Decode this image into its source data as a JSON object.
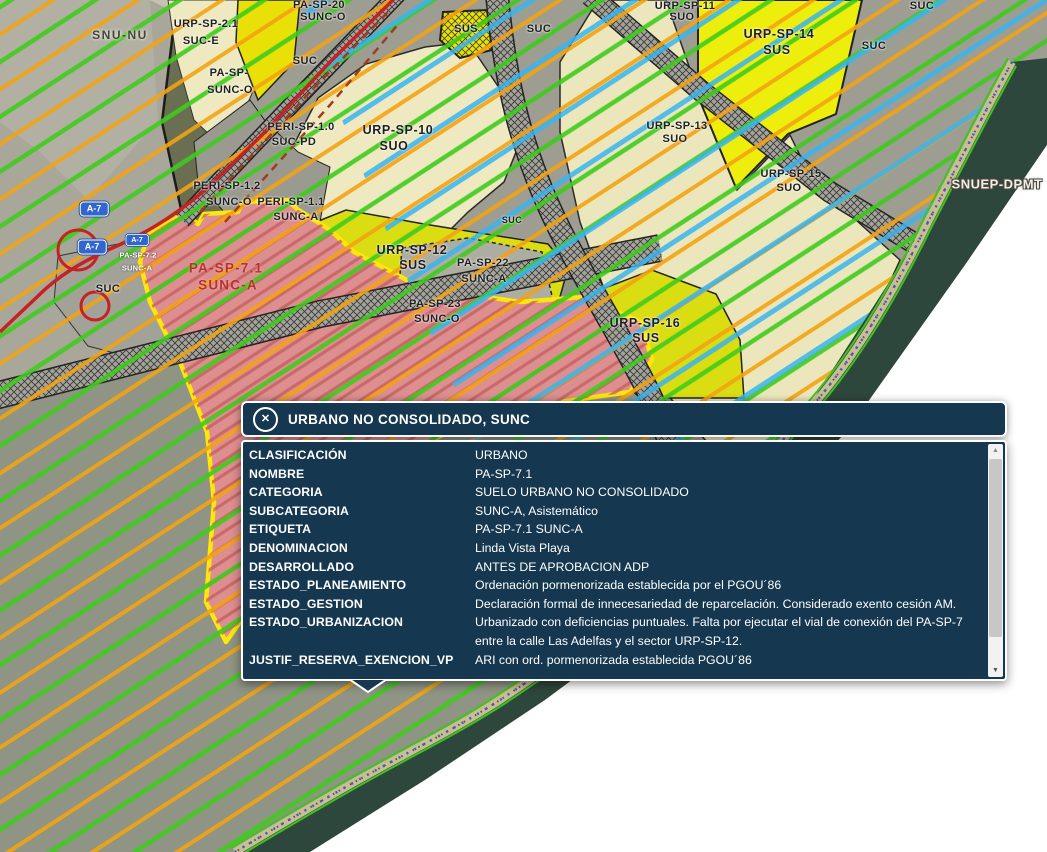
{
  "popup": {
    "title": "URBANO NO CONSOLIDADO, SUNC",
    "close_icon": "circled-x",
    "rows": [
      {
        "label": "CLASIFICACIÓN",
        "value": "URBANO"
      },
      {
        "label": "NOMBRE",
        "value": "PA-SP-7.1"
      },
      {
        "label": "CATEGORIA",
        "value": "SUELO URBANO NO CONSOLIDADO"
      },
      {
        "label": "SUBCATEGORIA",
        "value": "SUNC-A, Asistemático"
      },
      {
        "label": "ETIQUETA",
        "value": "PA-SP-7.1 SUNC-A"
      },
      {
        "label": "DENOMINACION",
        "value": "Linda Vista Playa"
      },
      {
        "label": "DESARROLLADO",
        "value": "ANTES DE APROBACION ADP"
      },
      {
        "label": "ESTADO_PLANEAMIENTO",
        "value": "Ordenación pormenorizada establecida por el PGOU´86"
      },
      {
        "label": "ESTADO_GESTION",
        "value": "Declaración formal de innecesariedad de reparcelación. Considerado exento cesión AM."
      },
      {
        "label": "ESTADO_URBANIZACION",
        "value": "Urbanizado con deficiencias puntuales. Falta por ejecutar el vial de conexión del PA-SP-7 entre la calle Las Adelfas y el sector URP-SP-12."
      },
      {
        "label": "JUSTIF_RESERVA_EXENCION_VP",
        "value": "ARI con ord. pormenorizada establecida PGOU´86"
      }
    ]
  },
  "map": {
    "labels": [
      {
        "t": "SNU-NU",
        "x": 120,
        "y": 35,
        "c": "muted"
      },
      {
        "t": "URP-SP-2.1",
        "x": 206,
        "y": 24
      },
      {
        "t": "SUC-E",
        "x": 201,
        "y": 41
      },
      {
        "t": "PA-SP-20",
        "x": 319,
        "y": 5
      },
      {
        "t": "SUNC-O",
        "x": 323,
        "y": 17
      },
      {
        "t": "PA-SP-",
        "x": 229,
        "y": 73
      },
      {
        "t": "SUNC-O",
        "x": 230,
        "y": 90
      },
      {
        "t": "SUC",
        "x": 305,
        "y": 61
      },
      {
        "t": "SUS",
        "x": 466,
        "y": 29
      },
      {
        "t": "SUC",
        "x": 539,
        "y": 29
      },
      {
        "t": "URP-SP-11",
        "x": 685,
        "y": 6
      },
      {
        "t": "SUO",
        "x": 682,
        "y": 17
      },
      {
        "t": "URP-SP-14",
        "x": 779,
        "y": 34,
        "c": "big"
      },
      {
        "t": "SUS",
        "x": 777,
        "y": 50,
        "c": "big"
      },
      {
        "t": "SUC",
        "x": 922,
        "y": 6
      },
      {
        "t": "SUC",
        "x": 874,
        "y": 46
      },
      {
        "t": "PERI-SP-1.0",
        "x": 301,
        "y": 127
      },
      {
        "t": "SUC-PD",
        "x": 294,
        "y": 142
      },
      {
        "t": "URP-SP-10",
        "x": 398,
        "y": 130,
        "c": "big"
      },
      {
        "t": "SUO",
        "x": 394,
        "y": 146,
        "c": "big"
      },
      {
        "t": "URP-SP-13",
        "x": 677,
        "y": 126
      },
      {
        "t": "SUO",
        "x": 675,
        "y": 139
      },
      {
        "t": "URP-SP-15",
        "x": 791,
        "y": 174
      },
      {
        "t": "SUO",
        "x": 789,
        "y": 188
      },
      {
        "t": "SNUEP-DPMT",
        "x": 997,
        "y": 184,
        "c": "coast"
      },
      {
        "t": "PERI-SP-1.2",
        "x": 227,
        "y": 186
      },
      {
        "t": "SUNC-O",
        "x": 229,
        "y": 202
      },
      {
        "t": "PERI-SP-1.1",
        "x": 291,
        "y": 202
      },
      {
        "t": "SUNC-A",
        "x": 296,
        "y": 217
      },
      {
        "t": "URP-SP-12",
        "x": 412,
        "y": 250,
        "c": "big"
      },
      {
        "t": "SUS",
        "x": 413,
        "y": 265,
        "c": "big"
      },
      {
        "t": "PA-SP-22",
        "x": 483,
        "y": 263
      },
      {
        "t": "SUNC-A",
        "x": 484,
        "y": 279
      },
      {
        "t": "PA-SP-23",
        "x": 435,
        "y": 304
      },
      {
        "t": "SUNC-O",
        "x": 437,
        "y": 319
      },
      {
        "t": "SUC",
        "x": 512,
        "y": 220,
        "c": "sm"
      },
      {
        "t": "URP-SP-16",
        "x": 645,
        "y": 323,
        "c": "big"
      },
      {
        "t": "SUS",
        "x": 646,
        "y": 338,
        "c": "big"
      },
      {
        "t": "PA-SP-7.1",
        "x": 226,
        "y": 268,
        "c": "red"
      },
      {
        "t": "SUNC-A",
        "x": 228,
        "y": 285,
        "c": "red"
      },
      {
        "t": "PA-SP-7.2",
        "x": 138,
        "y": 255,
        "c": "tiny"
      },
      {
        "t": "SUNC-A",
        "x": 137,
        "y": 268,
        "c": "tiny"
      },
      {
        "t": "SUC",
        "x": 108,
        "y": 289
      }
    ],
    "shields": [
      {
        "t": "A-7",
        "x": 94,
        "y": 209
      },
      {
        "t": "A-7",
        "x": 92,
        "y": 247
      },
      {
        "t": "A-7",
        "x": 137,
        "y": 240,
        "small": true
      }
    ],
    "colors": {
      "popup_bg": "#15374f",
      "zone_sus_yellow": "#e9e40b",
      "zone_suo_cream": "#efe9c2",
      "zone_sunc_red": "#dd8f8f",
      "zone_outline_yellow": "#ffe70a",
      "stripe_green": "#3fcb1d",
      "stripe_orange": "#f3a312",
      "stripe_cyan": "#38b4ef",
      "sea_green": "#2e473c",
      "road_red": "#c52222",
      "shield_blue": "#3166cf"
    }
  }
}
